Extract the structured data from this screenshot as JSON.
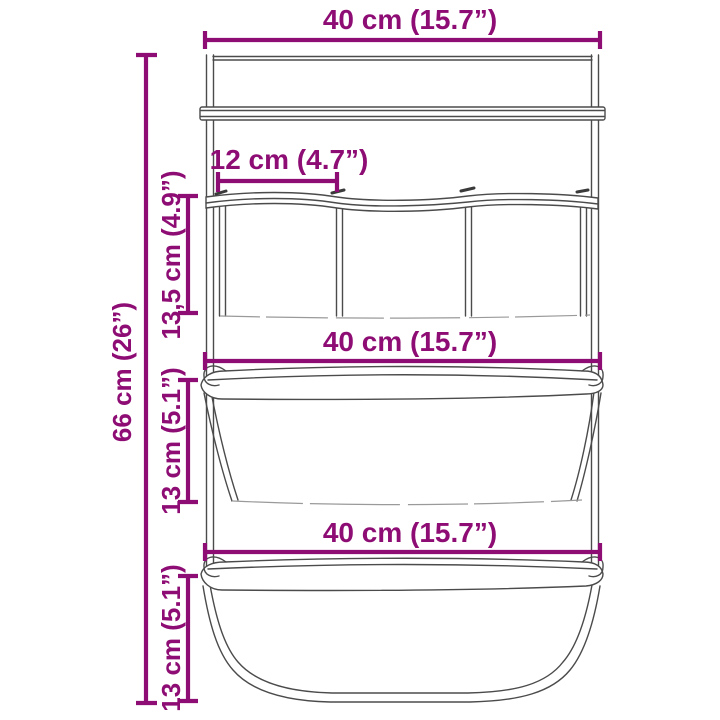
{
  "diagram": {
    "subject": "hanging-storage-organizer-with-pockets-and-baskets",
    "accent_color": "#8E0D74",
    "line_color": "#4B4B4B",
    "background_color": "#FFFFFF",
    "dimensions": {
      "top_width": "40 cm (15.7”)",
      "pocket_width": "12 cm (4.7”)",
      "pocket_height": "13,5 cm (4.9”)",
      "overall_height": "66 cm (26”)",
      "middle_width": "40 cm (15.7”)",
      "middle_basket_height": "13 cm (5.1”)",
      "bottom_width": "40 cm (15.7”)",
      "bottom_basket_height": "13 cm (5.1”)"
    }
  }
}
